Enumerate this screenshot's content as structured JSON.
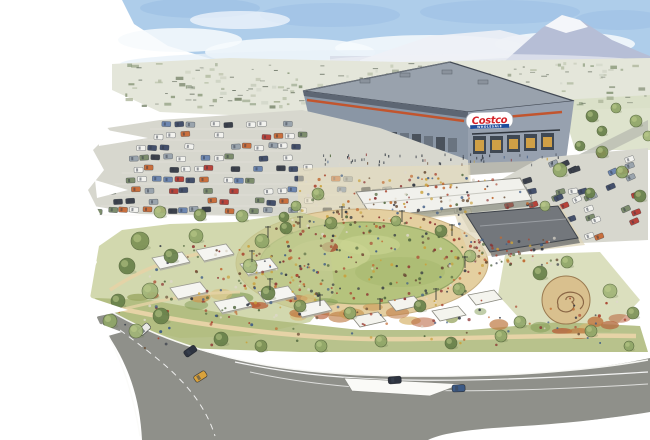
{
  "scene": {
    "alt": "Watercolor aerial rendering of a Costco warehouse store with a large parking lot, a landscaped public event park with an oval lawn full of people, white market tents, a pavilion, gardens and curving roads, with a snow-capped mountain and town in the distance. The painting has torn white paper edges on the left and bottom.",
    "sign": {
      "brand": "Costco",
      "sub": "WHOLESALE"
    }
  },
  "palette": {
    "paper": "#ffffff",
    "sky": "#aecdea",
    "skyDeep": "#9cc0e4",
    "cloud": "#f7fafd",
    "mountain": "#b6bed6",
    "snow": "#f4f6fa",
    "ridge": "#d3d7e4",
    "town": "#e4e6da",
    "wall": "#8a96a5",
    "wallFront": "#97a1af",
    "roof": "#99a2ad",
    "roofEdge": "#434a55",
    "stripe": "#c2552e",
    "signRed": "#d42127",
    "signBlue": "#1f4e9c",
    "lot": "#d7d7ce",
    "lawn": "#b5c37d",
    "ringTan": "#e4cfa0",
    "pavilionRoof": "#73777c",
    "canopy": "#f4f4f0",
    "road": "#8f908a",
    "garden": "#aeba7c",
    "path": "#e6d3a6"
  },
  "gen": {
    "seed": 7,
    "town": {
      "x0": 125,
      "x1": 645,
      "y0": 62,
      "y1": 106,
      "count": 150,
      "dashCount": 70,
      "colors": [
        "#b6bfa6",
        "#a9b296",
        "#c6cbb9",
        "#93a083",
        "#7e8a70",
        "#cfd3c6",
        "#8b9a7c"
      ],
      "dashColor": "#4d5748"
    },
    "carPalette": [
      "#f2f2ee",
      "#f2f2ee",
      "#44506b",
      "#6e87b0",
      "#c96f3d",
      "#3c414b",
      "#9aa4ad",
      "#7d8d6d",
      "#b8433a"
    ],
    "mainLot": {
      "rows": [
        122,
        133,
        144,
        155,
        166,
        177,
        188,
        199,
        208
      ],
      "step": 12,
      "skip": 0.38
    },
    "frontLot": {
      "x0": 455,
      "x1": 588,
      "y0": 184,
      "y1": 228,
      "count": 20,
      "rot": -15
    },
    "rightLot": {
      "x0": 522,
      "x1": 645,
      "y0": 152,
      "y1": 236,
      "count": 30,
      "rot": -20
    },
    "peoplePalette": [
      "#a8432e",
      "#c06a33",
      "#3c5a85",
      "#2e3440",
      "#ded8ca",
      "#6b4f38",
      "#52683f",
      "#8a2f2f",
      "#c9a13c"
    ],
    "crowds": [
      {
        "type": "ellipse",
        "cx": 362,
        "cy": 263,
        "rx": 100,
        "ry": 40,
        "count": 150,
        "edgeBias": 0.6
      },
      {
        "type": "ring",
        "cx": 362,
        "cy": 263,
        "rx": 112,
        "ry": 47,
        "count": 70
      },
      {
        "type": "rect",
        "x0": 300,
        "x1": 468,
        "y0": 172,
        "y1": 228,
        "count": 90
      },
      {
        "type": "rect",
        "x0": 468,
        "x1": 560,
        "y0": 236,
        "y1": 266,
        "count": 70
      },
      {
        "type": "rect",
        "x0": 148,
        "x1": 310,
        "y0": 244,
        "y1": 318,
        "count": 80
      },
      {
        "type": "rect",
        "x0": 110,
        "x1": 630,
        "y0": 298,
        "y1": 348,
        "count": 80
      },
      {
        "type": "rect",
        "x0": 360,
        "x1": 530,
        "y0": 178,
        "y1": 214,
        "count": 40
      }
    ],
    "frontWalk": {
      "x0": 322,
      "x1": 560,
      "y0": 153,
      "y1": 164,
      "count": 55
    },
    "treeColors": [
      "#7c9155",
      "#90a668",
      "#68814a",
      "#a2b578"
    ],
    "trees": [
      [
        160,
        212,
        6
      ],
      [
        200,
        215,
        6
      ],
      [
        242,
        216,
        6
      ],
      [
        284,
        217,
        5
      ],
      [
        318,
        194,
        6
      ],
      [
        296,
        206,
        5
      ],
      [
        560,
        170,
        7
      ],
      [
        602,
        152,
        6
      ],
      [
        622,
        172,
        6
      ],
      [
        590,
        193,
        5
      ],
      [
        545,
        206,
        5
      ],
      [
        640,
        196,
        6
      ],
      [
        592,
        116,
        6
      ],
      [
        616,
        108,
        5
      ],
      [
        636,
        121,
        6
      ],
      [
        648,
        136,
        5
      ],
      [
        602,
        131,
        5
      ],
      [
        580,
        146,
        5
      ],
      [
        140,
        241,
        9
      ],
      [
        127,
        266,
        8
      ],
      [
        150,
        291,
        8
      ],
      [
        171,
        256,
        7
      ],
      [
        196,
        236,
        7
      ],
      [
        118,
        301,
        7
      ],
      [
        161,
        316,
        8
      ],
      [
        136,
        331,
        7
      ],
      [
        262,
        241,
        7
      ],
      [
        250,
        266,
        7
      ],
      [
        268,
        293,
        7
      ],
      [
        300,
        306,
        6
      ],
      [
        350,
        313,
        6
      ],
      [
        420,
        306,
        6
      ],
      [
        459,
        289,
        6
      ],
      [
        470,
        256,
        6
      ],
      [
        441,
        231,
        6
      ],
      [
        396,
        221,
        5
      ],
      [
        331,
        223,
        6
      ],
      [
        286,
        228,
        6
      ],
      [
        110,
        321,
        7
      ],
      [
        221,
        339,
        7
      ],
      [
        261,
        346,
        6
      ],
      [
        321,
        346,
        6
      ],
      [
        381,
        341,
        6
      ],
      [
        451,
        343,
        6
      ],
      [
        501,
        336,
        6
      ],
      [
        540,
        273,
        7
      ],
      [
        610,
        291,
        7
      ],
      [
        633,
        313,
        6
      ],
      [
        591,
        331,
        6
      ],
      [
        629,
        346,
        5
      ],
      [
        567,
        262,
        6
      ],
      [
        520,
        322,
        6
      ]
    ],
    "tents": [
      [
        152,
        252
      ],
      [
        196,
        244
      ],
      [
        240,
        258
      ],
      [
        170,
        282
      ],
      [
        214,
        296
      ],
      [
        258,
        286
      ],
      [
        294,
        300
      ]
    ],
    "sails": [
      [
        388,
        296
      ],
      [
        432,
        306
      ],
      [
        468,
        290
      ],
      [
        352,
        312
      ]
    ],
    "umbrellas": [
      [
        318,
        228
      ],
      [
        331,
        233
      ],
      [
        344,
        229
      ],
      [
        357,
        234
      ],
      [
        369,
        230
      ],
      [
        325,
        221
      ],
      [
        350,
        223
      ]
    ],
    "poles": [
      [
        268,
        238
      ],
      [
        252,
        262
      ],
      [
        270,
        290
      ],
      [
        320,
        306
      ],
      [
        380,
        310
      ],
      [
        436,
        300
      ],
      [
        465,
        268
      ],
      [
        452,
        236
      ],
      [
        402,
        222
      ],
      [
        342,
        218
      ],
      [
        300,
        228
      ]
    ],
    "roadCars": [
      [
        183,
        352,
        "#2e3440",
        -35
      ],
      [
        193,
        377,
        "#d9a23c",
        -32
      ],
      [
        388,
        377,
        "#2e3440",
        -4
      ],
      [
        137,
        331,
        "#e9e9e4",
        -42
      ],
      [
        452,
        385,
        "#3c5a85",
        -2
      ]
    ],
    "gardenBlobs": {
      "count": 30,
      "colors": [
        "#bf7a44",
        "#c99b56",
        "#97a55f",
        "#88a05c",
        "#d9b873",
        "#b65c35"
      ]
    }
  }
}
